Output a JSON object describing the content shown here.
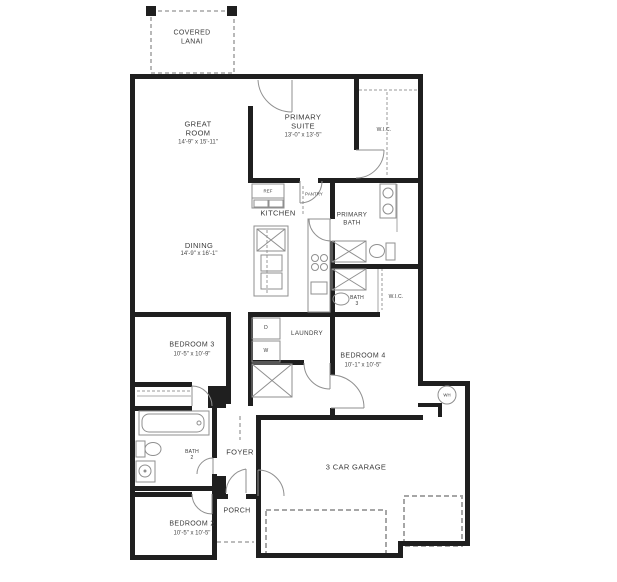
{
  "plan_title": "Single-story floor plan",
  "rooms": {
    "covered_lanai": {
      "line1": "COVERED",
      "line2": "LANAI"
    },
    "great_room": {
      "line1": "GREAT",
      "line2": "ROOM",
      "dims": "14'-9\" x 15'-11\""
    },
    "primary_suite": {
      "line1": "PRIMARY",
      "line2": "SUITE",
      "dims": "13'-0\" x 13'-5\""
    },
    "wic_top": {
      "name": "W.I.C."
    },
    "kitchen": {
      "name": "KITCHEN"
    },
    "pantry": {
      "name": "PANTRY"
    },
    "ref": {
      "name": "REF"
    },
    "primary_bath": {
      "line1": "PRIMARY",
      "line2": "BATH"
    },
    "dining": {
      "name": "DINING",
      "dims": "14'-9\" x 16'-1\""
    },
    "bath_3": {
      "line1": "BATH",
      "line2": "3"
    },
    "wic_mid": {
      "name": "W.I.C."
    },
    "laundry": {
      "name": "LAUNDRY"
    },
    "dryer": {
      "name": "D"
    },
    "washer": {
      "name": "W"
    },
    "bedroom_4": {
      "name": "BEDROOM 4",
      "dims": "10'-1\" x 10'-5\""
    },
    "bedroom_3": {
      "name": "BEDROOM 3",
      "dims": "10'-5\" x 10'-9\""
    },
    "bath_2": {
      "line1": "BATH",
      "line2": "2"
    },
    "foyer": {
      "name": "FOYER"
    },
    "garage": {
      "name": "3 CAR GARAGE"
    },
    "water_heater": {
      "name": "WH"
    },
    "porch": {
      "name": "PORCH"
    },
    "bedroom_2": {
      "name": "BEDROOM 2",
      "dims": "10'-5\" x 10'-5\""
    }
  },
  "colors": {
    "wall": "#1f1f1f",
    "fixture": "#8f8f8f",
    "dash": "#a6a6a6",
    "window": "#b5b5b5",
    "text": "#3a3a3a"
  }
}
